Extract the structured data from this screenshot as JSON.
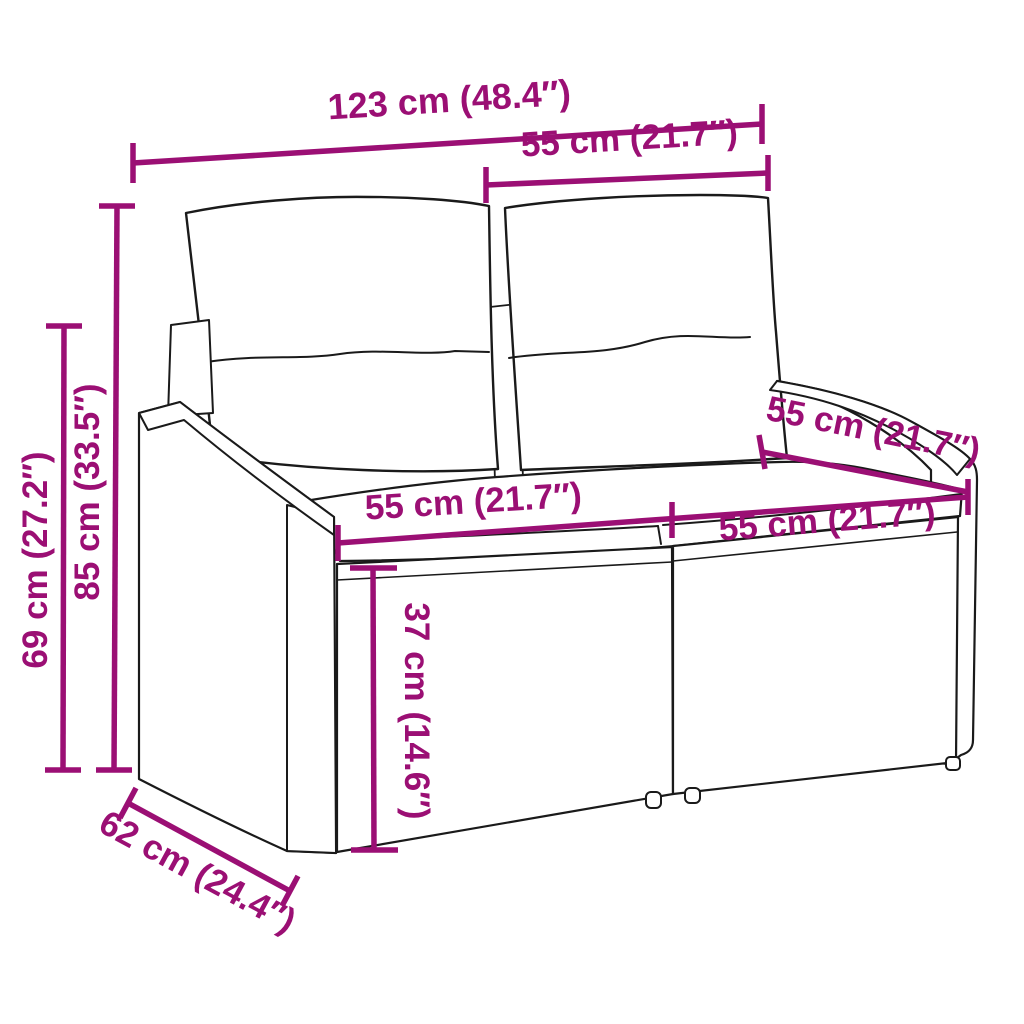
{
  "diagram": {
    "description": "Rattan two-seater garden sofa with back and seat cushions, annotated with product dimensions",
    "accent_color": "#9B0F74",
    "outline_color": "#1a1a1a",
    "background_color": "#ffffff",
    "dims": {
      "overall_width": "123 cm (48.4″)",
      "back_cushion_width": "55 cm (21.7″)",
      "total_height": "85 cm (33.5″)",
      "arm_height": "69 cm (27.2″)",
      "seat_width_left": "55 cm (21.7″)",
      "seat_width_right": "55 cm (21.7″)",
      "seat_depth": "55 cm (21.7″)",
      "seat_height": "37 cm (14.6″)",
      "base_depth": "62 cm (24.4″)"
    }
  }
}
